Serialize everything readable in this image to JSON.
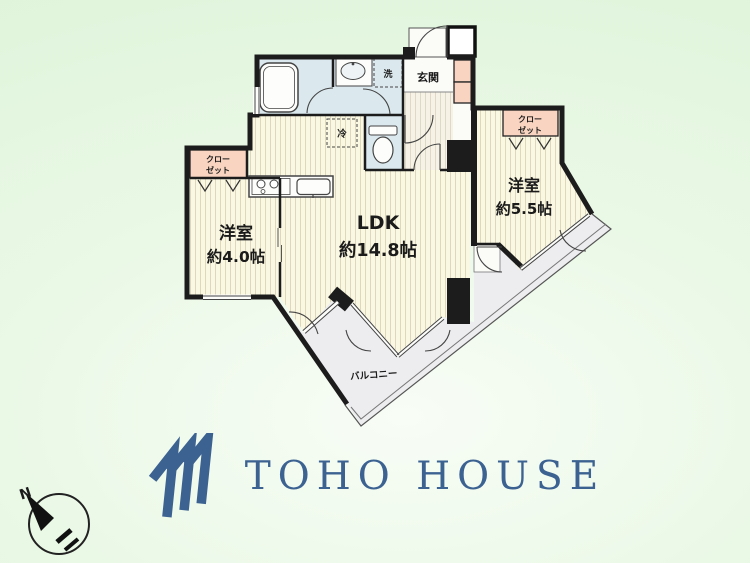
{
  "floorplan": {
    "labels": {
      "genkan": "玄関",
      "washer": "洗",
      "fridge": "冷",
      "closet_line1": "クロー",
      "closet_line2": "ゼット",
      "room_left_name": "洋室",
      "room_left_size": "約4.0帖",
      "ldk_name": "LDK",
      "ldk_size": "約14.8帖",
      "room_right_name": "洋室",
      "room_right_size": "約5.5帖",
      "balcony": "バルコニー"
    },
    "colors": {
      "wall": "#1c1c1c",
      "room_fill": "#faf7e2",
      "room_stripe": "#ddd8ba",
      "wet_area_fill": "#dbe9ee",
      "closet_fill": "#f8d4c1",
      "balcony_fill": "#ededf0",
      "background_green": "#def4da"
    }
  },
  "compass": {
    "north_label": "N"
  },
  "logo": {
    "text": "TOHO HOUSE",
    "color": "#3c6292"
  }
}
